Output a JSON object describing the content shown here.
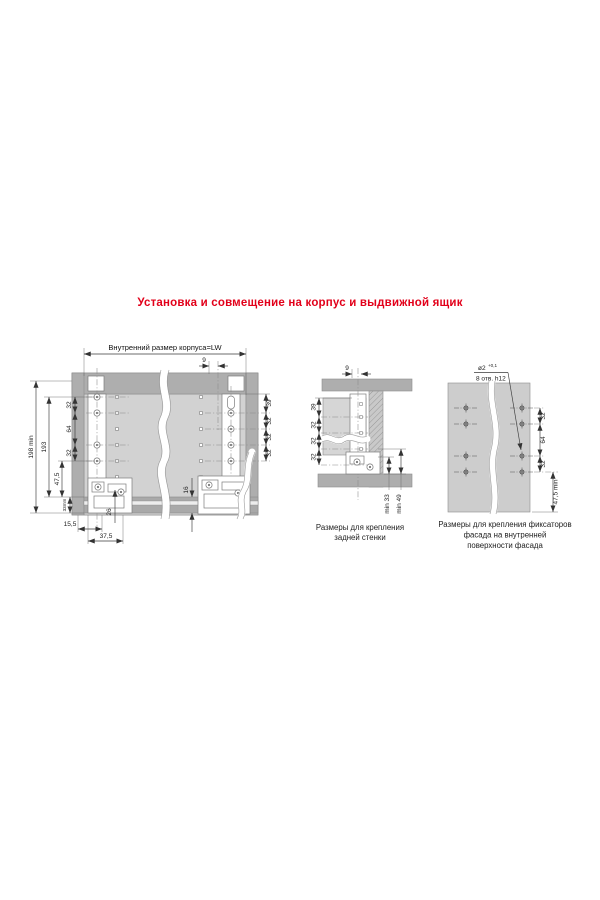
{
  "title": "Установка и совмещение на корпус и выдвижной ящик",
  "main_view": {
    "top_dim": "Внутренний размер корпуса=LW",
    "dim_9": "9",
    "left_chain": [
      "32",
      "64",
      "32"
    ],
    "d198": "198 min",
    "d193": "193",
    "d47": "47,5",
    "d33": "33mm",
    "d155": "15,5",
    "d375": "37,5",
    "d26": "26",
    "d16": "16",
    "right_chain": [
      "39",
      "32",
      "32",
      "32"
    ]
  },
  "back_view": {
    "dim_9": "9",
    "left_chain": [
      "39",
      "32",
      "32",
      "32"
    ],
    "min_dims": [
      "min 33",
      "min 49"
    ],
    "caption": [
      "Размеры для крепления",
      "задней стенки"
    ]
  },
  "facade_view": {
    "hole_dia": "ø2",
    "hole_tol": "+0,1",
    "hole_note": "8 отв. h12",
    "right_chain": [
      "32",
      "64",
      "32"
    ],
    "d475": "47,5 min",
    "caption": [
      "Размеры для крепления фиксаторов",
      "фасада на внутренней",
      "поверхности фасада"
    ]
  },
  "colors": {
    "accent": "#e2001a",
    "panel": "#c6c6c6",
    "panel_dark": "#aeaeae"
  }
}
